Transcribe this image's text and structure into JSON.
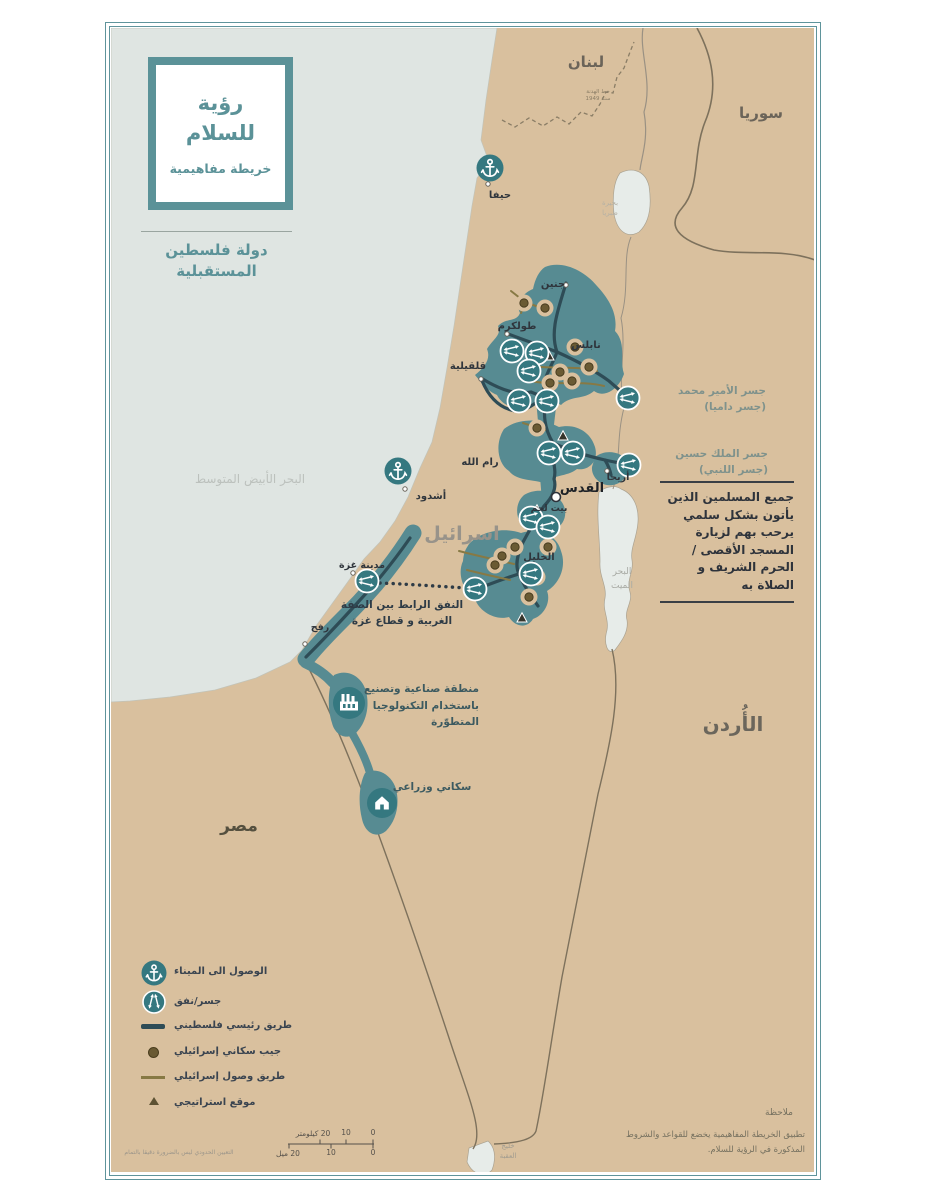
{
  "colors": {
    "accent_teal": "#578b92",
    "icon_teal": "#357880",
    "land": "#d9c09e",
    "sea": "#dfe5e2",
    "palestinian_road": "#2e4c56",
    "israeli_road": "#877944",
    "israeli_enclave": "#6a5a33",
    "frame": "#5f949b",
    "title_teal": "#5b9298"
  },
  "title_box": {
    "line1": "رؤية",
    "line2": "للسلام",
    "subtitle": "خريطة مفاهيمية"
  },
  "future_state": {
    "line1": "دولة فلسطين",
    "line2": "المستقبلية"
  },
  "countries": {
    "lebanon": "لبنان",
    "syria": "سوريا",
    "israel": "اسرائيل",
    "jordan": "الأُردن",
    "egypt": "مصر"
  },
  "water_labels": {
    "mediterranean": "البحر الأبيض المتوسط",
    "dead_sea": [
      "البحر",
      "الميت"
    ],
    "tiberias": [
      "بحيرة",
      "طبريا"
    ],
    "aqaba": [
      "خليج",
      "العقبة"
    ]
  },
  "cities": {
    "haifa": "حيفا",
    "ashdod": "أشدود",
    "jenin": "جنين",
    "tulkarm": "طولكرم",
    "nablus": "نابلس",
    "qalqilya": "قلقيلية",
    "ramallah": "رام الله",
    "jericho": "أريحا",
    "jerusalem": "القدس",
    "bethlehem": "بيت لحم",
    "hebron": "الخليل",
    "gaza_city": "مدينة غزة",
    "rafah": "رفح"
  },
  "bridges": {
    "damia": [
      "جسر الأمير محمد",
      "(جسر داميا)"
    ],
    "hussein": [
      "جسر الملك حسين",
      "(جسر اللنبي)"
    ]
  },
  "annotations": {
    "armistice": [
      "خط الهدنة",
      "سنة 1949"
    ],
    "tunnel": [
      "النفق الرابط بين الضفة",
      "الغربية و قطاع غزة"
    ],
    "industrial": [
      "منطقة صناعية وتصنيع",
      "باستخدام التكنولوجيا",
      "المتطوّرة"
    ],
    "agricultural": "سكاني وزراعي",
    "aqsa_note": [
      "جميع المسلمين الذين",
      "يأتون بشكل سلمي يرحب",
      "بهم لزيارة المسجد الأقصى",
      "/الحرم الشريف و الصلاة به"
    ]
  },
  "legend": {
    "items": [
      {
        "icon": "anchor-icon",
        "label": "الوصول الى الميناء"
      },
      {
        "icon": "bridge-tunnel-icon",
        "label": "جسر/نفق"
      },
      {
        "icon": "palestinian-road-line",
        "label": "طريق رئيسي فلسطيني"
      },
      {
        "icon": "israeli-enclave-dot",
        "label": "جيب سكاني إسرائيلي"
      },
      {
        "icon": "israeli-access-road-line",
        "label": "طريق وصول إسرائيلي"
      },
      {
        "icon": "strategic-site-triangle",
        "label": "موقع استراتيجي"
      }
    ]
  },
  "scale_bar": {
    "km": {
      "zero": "0",
      "ten": "10",
      "twenty": "20 كيلومتر"
    },
    "miles": {
      "zero": "0",
      "ten": "10",
      "twenty": "20 ميل"
    }
  },
  "notes": {
    "heading": "ملاحظة",
    "body": [
      "تطبيق الخريطة المفاهيمية يخضع للقواعد والشروط",
      "المذكورة في الرؤية للسلام."
    ],
    "disclaimer": "التعيين الحدودي ليس بالضرورة دقيقا بالتمام"
  }
}
